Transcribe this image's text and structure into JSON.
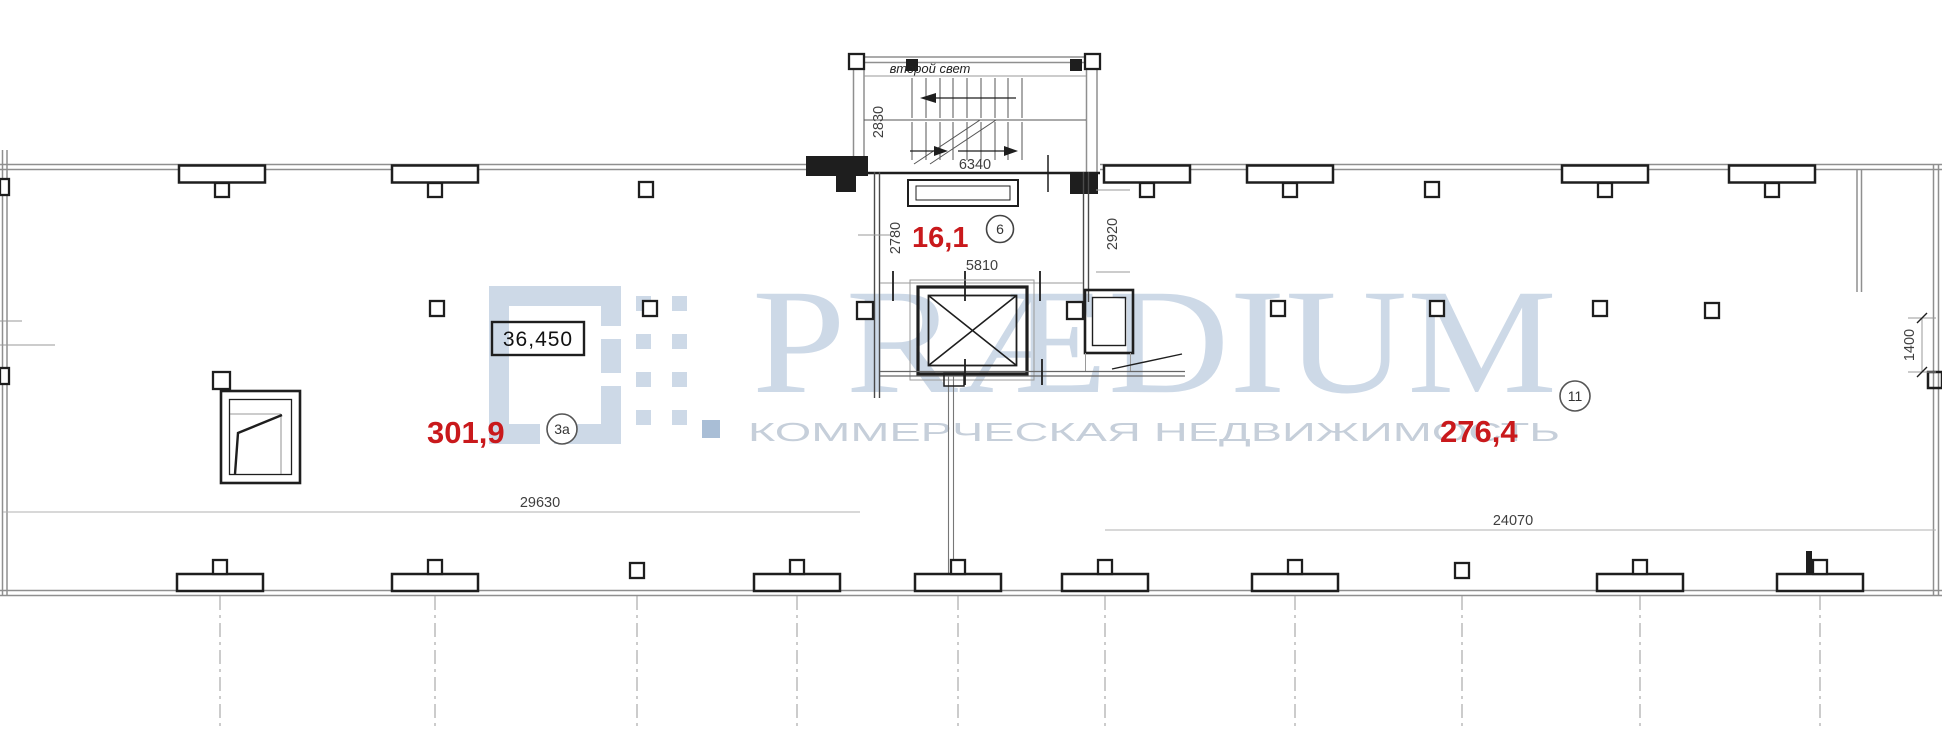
{
  "plan": {
    "watermark": {
      "brand": "PRÆDIUM",
      "tagline": "КОММЕРЧЕСКАЯ НЕДВИЖИМОСТЬ",
      "logo_color": "#cdd9e7",
      "brand_color": "#cdd9e7",
      "tagline_color": "#c6cfda",
      "bullet_color": "#a9bed6"
    },
    "labels": {
      "second_light": "второй свет",
      "level_mark": "36,450"
    },
    "rooms": [
      {
        "area": "16,1",
        "number": "6"
      },
      {
        "area": "301,9",
        "number": "3а"
      },
      {
        "area": "276,4",
        "number": "11"
      }
    ],
    "dimensions": {
      "stair_depth": "2830",
      "stair_run": "6340",
      "hall_left": "2780",
      "hall_width": "5810",
      "hall_right": "2920",
      "left_bay_span": "29630",
      "right_bay_span": "24070",
      "right_wall_offset": "1400"
    },
    "colors": {
      "area_label": "#c9191c",
      "line_dark": "#1e1e1e",
      "wall_gray": "#8f8f8f",
      "dim_line": "#b0b0b0",
      "dim_text": "#3f3f3f"
    }
  }
}
